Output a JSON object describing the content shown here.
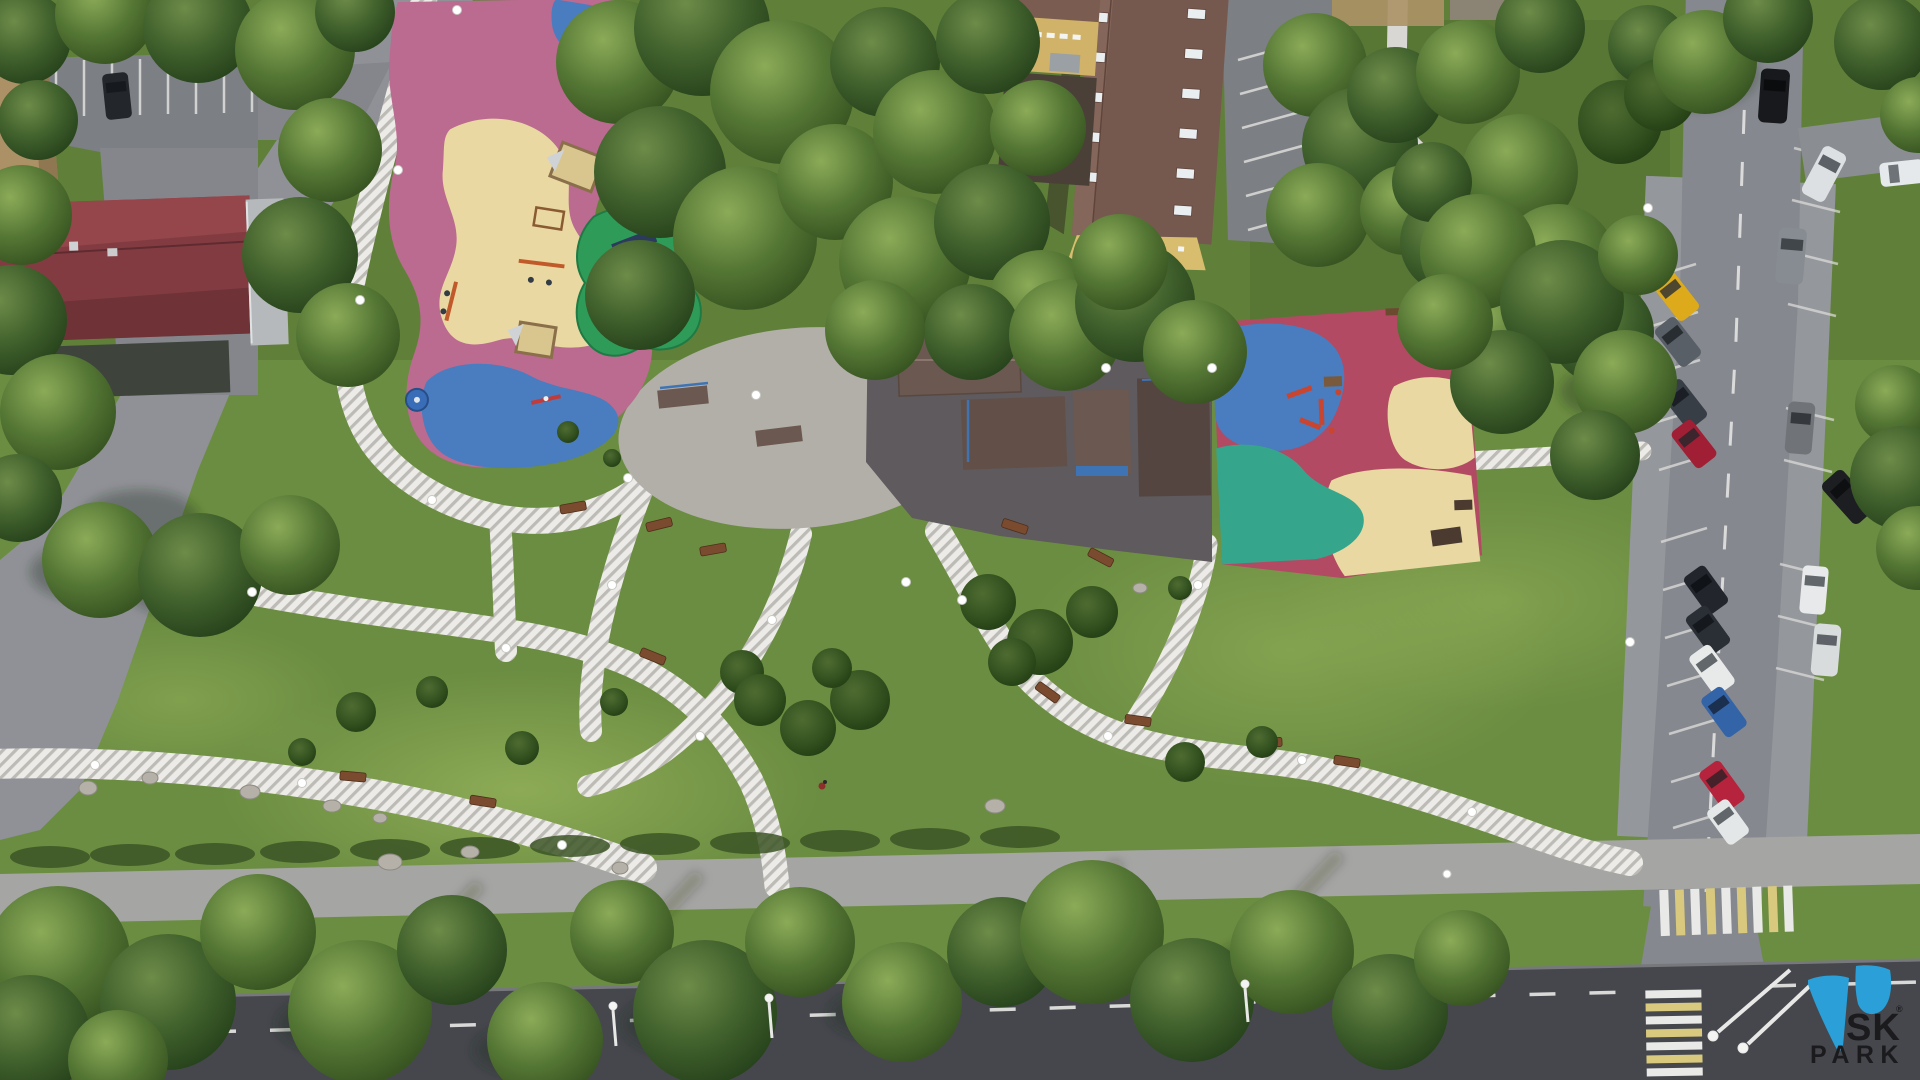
{
  "watermark": {
    "line1": "SK",
    "line2": "PARK",
    "registered": "®",
    "brand_color": "#2a9fd8",
    "text_color": "#1b1b1d"
  },
  "palette": {
    "grass": "#6b8d41",
    "grass_light": "#9cba62",
    "grass_dark": "#46602c",
    "road_left": "#8f9196",
    "road_right": "#85888e",
    "road_bottom": "#45474d",
    "sidewalk": "#a5a6a3",
    "parking": "#7c7f84",
    "courtyard": "#4a4038",
    "path_base": "#edebe7",
    "path_stripe": "#bdbbb6",
    "skate_concrete": "#b2afa9",
    "skate_asphalt": "#5e5a5d",
    "ramp_brown": "#6b5850",
    "rail_blue": "#3f74b4",
    "pg_pink": "#bb6a90",
    "pg_sand": "#e9d8a2",
    "pg_blue": "#4a7cc0",
    "pg_teal": "#35a68c",
    "pg_red": "#b34a63",
    "equip_green": "#2f9b59",
    "equip_navy": "#2c3a5e",
    "equip_red": "#c8452f",
    "roof_red": "#823c41",
    "roof_brown": "#76594e",
    "roof_tan": "#ac9166",
    "facade_yellow": "#d9bd6f",
    "zebra_yellow": "#d8c97e",
    "marking": "#e9e9e7",
    "bench_wood": "#7a4b2e",
    "boulder": "#b5b1a8",
    "lamp": "#ffffff"
  },
  "cars": [
    {
      "name": "black-car-parking-lot",
      "color": "#23262b"
    },
    {
      "name": "orange-car-courtyard",
      "color": "#d2571e"
    },
    {
      "name": "black-suv-right-road-top",
      "color": "#17191d"
    },
    {
      "name": "white-car-top-right-corner",
      "color": "#e9ecee"
    },
    {
      "name": "white-car-side-street",
      "color": "#e6e9eb"
    },
    {
      "name": "white-van-right-bay",
      "color": "#dce0e2"
    },
    {
      "name": "silver-suv-right-bay",
      "color": "#878c92"
    },
    {
      "name": "yellow-car-left-bay",
      "color": "#ddaa1c"
    },
    {
      "name": "gray-car-left-bay",
      "color": "#595f66"
    },
    {
      "name": "dark-gray-car-left-bay",
      "color": "#383e46"
    },
    {
      "name": "red-car-left-bay",
      "color": "#a01f35"
    },
    {
      "name": "gray-car-right-bay",
      "color": "#707479"
    },
    {
      "name": "black-van-right-bay",
      "color": "#1c1e22"
    },
    {
      "name": "black-car-left-bay-2",
      "color": "#22262c"
    },
    {
      "name": "black-car-left-bay-3",
      "color": "#2a2e35"
    },
    {
      "name": "white-car-left-bay",
      "color": "#e8eaea"
    },
    {
      "name": "blue-car-left-bay",
      "color": "#3464a8"
    },
    {
      "name": "red-car-left-bay-2",
      "color": "#b5233c"
    },
    {
      "name": "white-car-left-bay-2",
      "color": "#e4e7e8"
    },
    {
      "name": "white-car-right-bay-2",
      "color": "#e7e9ea"
    },
    {
      "name": "white-van-right-bay-2",
      "color": "#d9dcdd"
    }
  ]
}
